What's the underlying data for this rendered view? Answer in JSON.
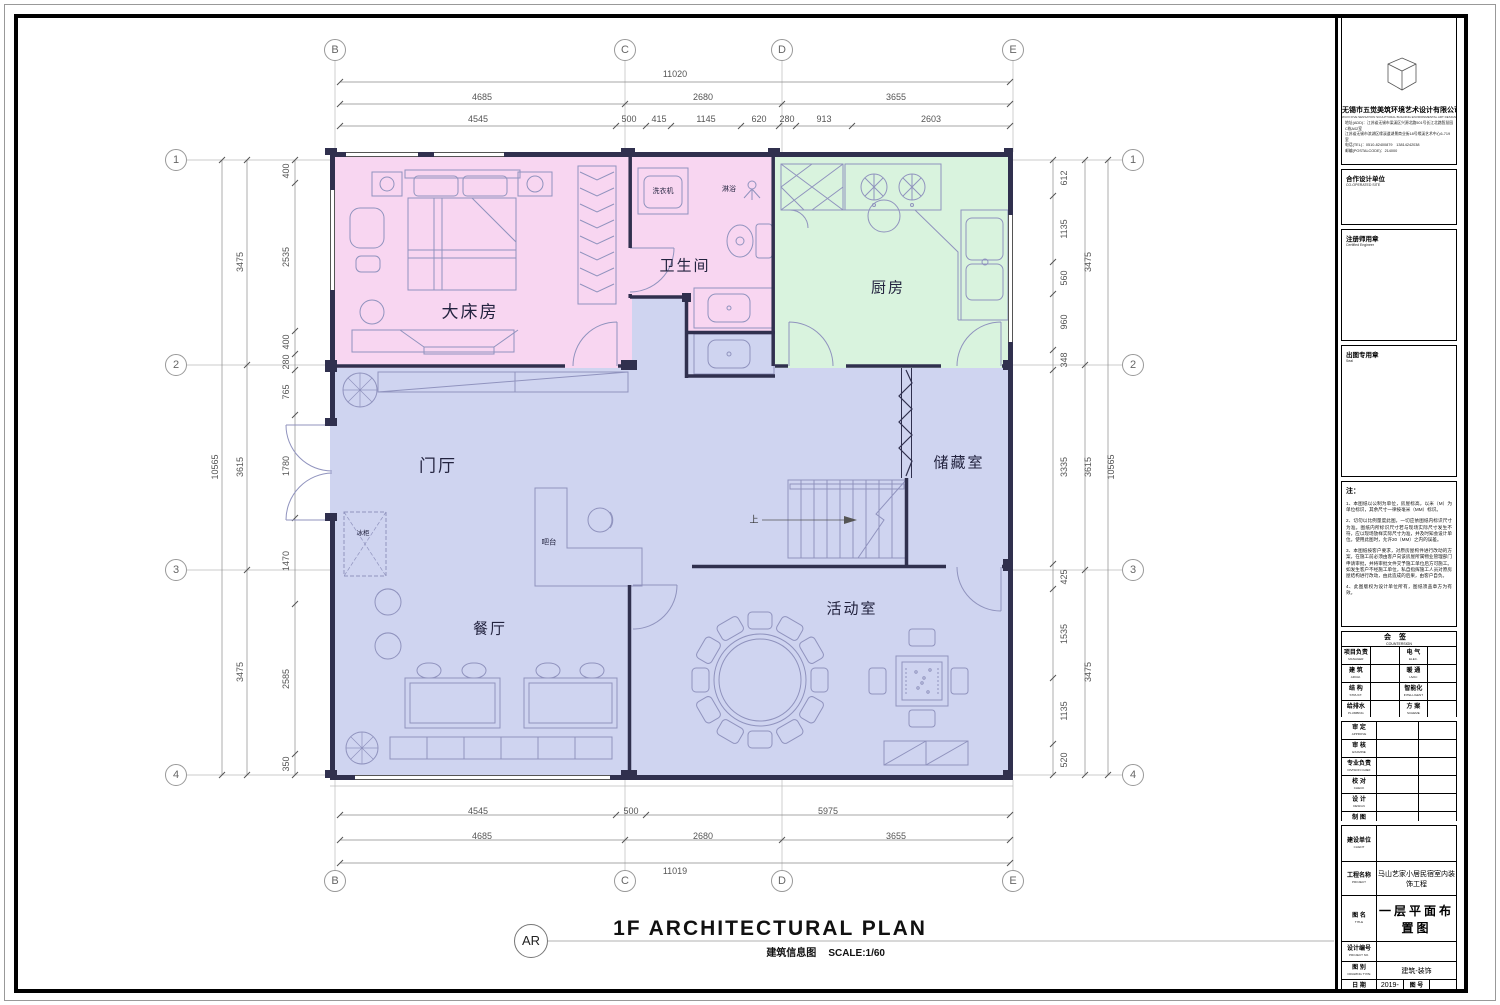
{
  "footer": {
    "detail_tag": "AR",
    "title": "1F ARCHITECTURAL PLAN",
    "subtitle_cn": "建筑信息图",
    "scale": "SCALE:1/60"
  },
  "colors": {
    "bedroom_fill": "#f8d6f1",
    "kitchen_fill": "#d9f3de",
    "living_fill": "#cfd4f0",
    "wall": "#30304e",
    "furniture": "#9093be",
    "dim_line": "#8a8a8a"
  },
  "grid": {
    "cols": [
      "B",
      "C",
      "D",
      "E"
    ],
    "rows": [
      "1",
      "2",
      "3",
      "4"
    ]
  },
  "rooms": {
    "master": "大床房",
    "bath": "卫生间",
    "kitchen": "厨房",
    "hall": "门厅",
    "storage": "储藏室",
    "dining": "餐厅",
    "activity": "活动室",
    "washer": "洗衣机",
    "shower": "淋浴",
    "freezer": "冰柜",
    "bar": "吧台",
    "stair_up": "上"
  },
  "dims": {
    "top": {
      "total": "11020",
      "row2": [
        "4685",
        "2680",
        "3655"
      ],
      "row3": [
        "4545",
        "500",
        "415",
        "1145",
        "620",
        "280",
        "913",
        "2603"
      ]
    },
    "bottom": {
      "row1": [
        "4545",
        "500",
        "5975"
      ],
      "row2": [
        "4685",
        "2680",
        "3655"
      ],
      "total": "11019"
    },
    "left": {
      "total": "10565",
      "mid": [
        "3475",
        "3615",
        "3475"
      ],
      "inner": [
        "400",
        "2535",
        "400",
        "280",
        "765",
        "1780",
        "1470",
        "2585",
        "350"
      ]
    },
    "right": {
      "total": "10565",
      "mid": [
        "3475",
        "3615",
        "3475"
      ],
      "inner": [
        "612",
        "1135",
        "560",
        "960",
        "348",
        "3335",
        "425",
        "1535",
        "1135",
        "520"
      ]
    }
  },
  "titleblock": {
    "company": {
      "name": "无锡市五觉美筑环境艺术设计有限公司",
      "name_en": "WUXI FIVE SENSATION SCULPTURAL BUILDING ENVIRONMENTAL ART DESIGN CO.,LTD",
      "addr1": "地址(ADD)：江苏省无锡市梁溪区兴源北路501号长江北路智慧园C栋A02室",
      "addr2": "江苏省无锡市滨湖区缘溪道湖景商业街18号缘溪艺术中心6-719室",
      "tel": "电话(TEL)：0510-82400879　13814242038",
      "post": "邮编(POSTALCODE)：214000"
    },
    "coop": {
      "cn": "合作设计单位",
      "en": "CO-OPERATED SITE"
    },
    "reg": {
      "cn": "注册师用章",
      "en": "Certified Engineer"
    },
    "seal": {
      "cn": "出图专用章",
      "en": "Seal"
    },
    "notes_title": "注：",
    "notes": [
      "1、本图纸以公制为单位，房屋标高，以米（M）为单位标识，其余尺寸一律按毫米（MM）标识。",
      "2、切勿以比例量度此图，一切应依图纸内标识尺寸为准。图纸内所标识尺寸若与现场实际尺寸发生不符，应以现场放样实际尺寸为准，并及时知会设计单位。使用此图时，允许20（MM）之内的误差。",
      "3、本图纸按客户要求，对原房屋构件进行改动的方案，在施工前必须由客户向该房屋所属物业管理部门申请审批，并将审批文件交予施工单位后方可施工。如发生客户不经施工单位，私自指挥施工人员对原房屋结构进行改动，由此造成的后果，由客户自负。",
      "4、此图版权为设计单位所有，图纸须盖章方为有效。"
    ],
    "countersign": {
      "cn": "会签",
      "en": "COUNTERSIGN",
      "rows": [
        [
          {
            "cn": "项目负责",
            "en": "MANAGER"
          },
          {
            "cn": "电  气",
            "en": "ELEC."
          }
        ],
        [
          {
            "cn": "建  筑",
            "en": "ARCHI."
          },
          {
            "cn": "暖  通",
            "en": "HVAC"
          }
        ],
        [
          {
            "cn": "结  构",
            "en": "STRUCT."
          },
          {
            "cn": "智能化",
            "en": "INTELLIGENT"
          }
        ],
        [
          {
            "cn": "给排水",
            "en": "PLUMBING"
          },
          {
            "cn": "方  案",
            "en": "SCHEME"
          }
        ]
      ]
    },
    "approval": [
      {
        "cn": "审  定",
        "en": "APPROVE"
      },
      {
        "cn": "审  核",
        "en": "EXAMINE"
      },
      {
        "cn": "专业负责",
        "en": "DIVISION CHIEF"
      },
      {
        "cn": "校  对",
        "en": "CHECK"
      },
      {
        "cn": "设  计",
        "en": "DESIGN"
      },
      {
        "cn": "制  图",
        "en": "DRAW"
      }
    ],
    "info": {
      "client": {
        "cn": "建设单位",
        "en": "CLIENT",
        "value": ""
      },
      "project": {
        "cn": "工程名称",
        "en": "PROJECT",
        "value": "马山艺家小居民宿室内装饰工程"
      },
      "title": {
        "cn": "图    名",
        "en": "TITLE",
        "value": "一层平面布置图"
      },
      "design_no": {
        "cn": "设计编号",
        "en": "PROJECT NO.",
        "value": ""
      },
      "type": {
        "cn": "图    别",
        "en": "DRAWING TYPE",
        "value": "建筑-装饰"
      },
      "date": {
        "cn": "日    期",
        "en": "DATE",
        "value": "2019-10-23"
      },
      "dwg": {
        "cn": "图    号",
        "en": "DWG NO.",
        "value": ""
      }
    }
  }
}
